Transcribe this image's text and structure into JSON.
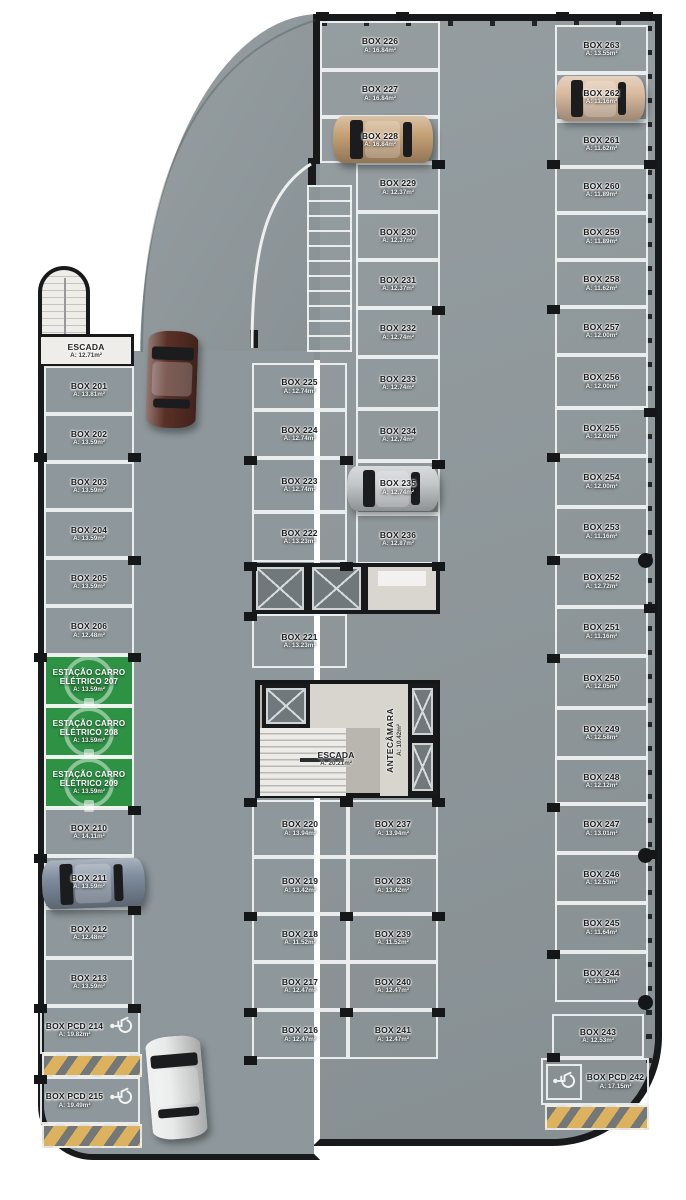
{
  "colors": {
    "floor": "#8e979b",
    "wall": "#17191b",
    "line": "#f4f6f6",
    "station_green": "#2e9245",
    "hatch_yellow": "#dcb25f"
  },
  "plan": {
    "rooms": {
      "stair_left": {
        "name": "ESCADA",
        "area": "A: 12.71m²"
      },
      "stair_core": {
        "name": "ESCADA",
        "area": "A: 20.21m²"
      },
      "antechamber": {
        "name": "ANTECÂMARA",
        "area": "A: 10.42m²"
      }
    },
    "boxes": [
      {
        "label": "BOX 201",
        "area": "A: 13.81m²",
        "x": 44,
        "y": 366,
        "w": 90,
        "h": 48
      },
      {
        "label": "BOX 202",
        "area": "A: 13.59m²",
        "x": 44,
        "y": 414,
        "w": 90,
        "h": 48
      },
      {
        "label": "BOX 203",
        "area": "A: 13.59m²",
        "x": 44,
        "y": 462,
        "w": 90,
        "h": 48
      },
      {
        "label": "BOX 204",
        "area": "A: 13.59m²",
        "x": 44,
        "y": 510,
        "w": 90,
        "h": 48
      },
      {
        "label": "BOX 205",
        "area": "A: 13.59m²",
        "x": 44,
        "y": 558,
        "w": 90,
        "h": 48
      },
      {
        "label": "BOX 206",
        "area": "A: 12.48m²",
        "x": 44,
        "y": 606,
        "w": 90,
        "h": 49
      },
      {
        "label": "BOX 210",
        "area": "A: 14.11m²",
        "x": 44,
        "y": 808,
        "w": 90,
        "h": 48
      },
      {
        "label": "BOX 211",
        "area": "A: 13.59m²",
        "x": 44,
        "y": 856,
        "w": 90,
        "h": 52
      },
      {
        "label": "BOX 212",
        "area": "A: 12.48m²",
        "x": 44,
        "y": 908,
        "w": 90,
        "h": 50
      },
      {
        "label": "BOX 213",
        "area": "A: 13.59m²",
        "x": 44,
        "y": 958,
        "w": 90,
        "h": 48
      },
      {
        "label": "BOX 216",
        "area": "A: 12.47m²",
        "x": 252,
        "y": 1010,
        "w": 96,
        "h": 49
      },
      {
        "label": "BOX 217",
        "area": "A: 12.47m²",
        "x": 252,
        "y": 962,
        "w": 96,
        "h": 48
      },
      {
        "label": "BOX 218",
        "area": "A: 11.52m²",
        "x": 252,
        "y": 914,
        "w": 96,
        "h": 48
      },
      {
        "label": "BOX 219",
        "area": "A: 13.42m²",
        "x": 252,
        "y": 857,
        "w": 96,
        "h": 57
      },
      {
        "label": "BOX 220",
        "area": "A: 13.94m²",
        "x": 252,
        "y": 800,
        "w": 96,
        "h": 57
      },
      {
        "label": "BOX 221",
        "area": "A: 13.23m²",
        "x": 252,
        "y": 614,
        "w": 95,
        "h": 54
      },
      {
        "label": "BOX 222",
        "area": "A: 13.23m²",
        "x": 252,
        "y": 512,
        "w": 95,
        "h": 50
      },
      {
        "label": "BOX 223",
        "area": "A: 12.74m²",
        "x": 252,
        "y": 458,
        "w": 95,
        "h": 54
      },
      {
        "label": "BOX 224",
        "area": "A: 12.74m²",
        "x": 252,
        "y": 410,
        "w": 95,
        "h": 48
      },
      {
        "label": "BOX 225",
        "area": "A: 12.74m²",
        "x": 252,
        "y": 363,
        "w": 95,
        "h": 47
      },
      {
        "label": "BOX 226",
        "area": "A: 16.84m²",
        "x": 320,
        "y": 21,
        "w": 120,
        "h": 49
      },
      {
        "label": "BOX 227",
        "area": "A: 16.84m²",
        "x": 320,
        "y": 70,
        "w": 120,
        "h": 47
      },
      {
        "label": "BOX 228",
        "area": "A: 16.84m²",
        "x": 320,
        "y": 117,
        "w": 120,
        "h": 46
      },
      {
        "label": "BOX 229",
        "area": "A: 12.37m²",
        "x": 356,
        "y": 163,
        "w": 84,
        "h": 49
      },
      {
        "label": "BOX 230",
        "area": "A: 12.37m²",
        "x": 356,
        "y": 212,
        "w": 84,
        "h": 48
      },
      {
        "label": "BOX 231",
        "area": "A: 12.37m²",
        "x": 356,
        "y": 260,
        "w": 84,
        "h": 48
      },
      {
        "label": "BOX 232",
        "area": "A: 12.74m²",
        "x": 356,
        "y": 308,
        "w": 84,
        "h": 49
      },
      {
        "label": "BOX 233",
        "area": "A: 12.74m²",
        "x": 356,
        "y": 357,
        "w": 84,
        "h": 52
      },
      {
        "label": "BOX 234",
        "area": "A: 12.74m²",
        "x": 356,
        "y": 409,
        "w": 84,
        "h": 52
      },
      {
        "label": "BOX 235",
        "area": "A: 12.74m²",
        "x": 356,
        "y": 461,
        "w": 84,
        "h": 53
      },
      {
        "label": "BOX 236",
        "area": "A: 12.87m²",
        "x": 356,
        "y": 514,
        "w": 84,
        "h": 50
      },
      {
        "label": "BOX 237",
        "area": "A: 13.94m²",
        "x": 348,
        "y": 800,
        "w": 90,
        "h": 57
      },
      {
        "label": "BOX 238",
        "area": "A: 13.42m²",
        "x": 348,
        "y": 857,
        "w": 90,
        "h": 57
      },
      {
        "label": "BOX 239",
        "area": "A: 11.52m²",
        "x": 348,
        "y": 914,
        "w": 90,
        "h": 48
      },
      {
        "label": "BOX 240",
        "area": "A: 12.47m²",
        "x": 348,
        "y": 962,
        "w": 90,
        "h": 48
      },
      {
        "label": "BOX 241",
        "area": "A: 12.47m²",
        "x": 348,
        "y": 1010,
        "w": 90,
        "h": 49
      },
      {
        "label": "BOX 243",
        "area": "A: 12.53m²",
        "x": 552,
        "y": 1014,
        "w": 92,
        "h": 44
      },
      {
        "label": "BOX 244",
        "area": "A: 12.53m²",
        "x": 555,
        "y": 952,
        "w": 93,
        "h": 50
      },
      {
        "label": "BOX 245",
        "area": "A: 11.64m²",
        "x": 555,
        "y": 903,
        "w": 93,
        "h": 49
      },
      {
        "label": "BOX 246",
        "area": "A: 12.53m²",
        "x": 555,
        "y": 853,
        "w": 93,
        "h": 50
      },
      {
        "label": "BOX 247",
        "area": "A: 13.01m²",
        "x": 555,
        "y": 804,
        "w": 93,
        "h": 49
      },
      {
        "label": "BOX 248",
        "area": "A: 12.12m²",
        "x": 555,
        "y": 758,
        "w": 93,
        "h": 46
      },
      {
        "label": "BOX 249",
        "area": "A: 12.58m²",
        "x": 555,
        "y": 708,
        "w": 93,
        "h": 50
      },
      {
        "label": "BOX 250",
        "area": "A: 12.05m²",
        "x": 555,
        "y": 656,
        "w": 93,
        "h": 52
      },
      {
        "label": "BOX 251",
        "area": "A: 11.16m²",
        "x": 555,
        "y": 607,
        "w": 93,
        "h": 49
      },
      {
        "label": "BOX 252",
        "area": "A: 12.72m²",
        "x": 555,
        "y": 556,
        "w": 93,
        "h": 51
      },
      {
        "label": "BOX 253",
        "area": "A: 11.16m²",
        "x": 555,
        "y": 507,
        "w": 93,
        "h": 49
      },
      {
        "label": "BOX 254",
        "area": "A: 12.00m²",
        "x": 555,
        "y": 456,
        "w": 93,
        "h": 51
      },
      {
        "label": "BOX 255",
        "area": "A: 12.00m²",
        "x": 555,
        "y": 408,
        "w": 93,
        "h": 48
      },
      {
        "label": "BOX 256",
        "area": "A: 12.00m²",
        "x": 555,
        "y": 355,
        "w": 93,
        "h": 53
      },
      {
        "label": "BOX 257",
        "area": "A: 12.00m²",
        "x": 555,
        "y": 307,
        "w": 93,
        "h": 48
      },
      {
        "label": "BOX 258",
        "area": "A: 11.62m²",
        "x": 555,
        "y": 260,
        "w": 93,
        "h": 47
      },
      {
        "label": "BOX 259",
        "area": "A: 11.89m²",
        "x": 555,
        "y": 213,
        "w": 93,
        "h": 47
      },
      {
        "label": "BOX 260",
        "area": "A: 11.89m²",
        "x": 555,
        "y": 167,
        "w": 93,
        "h": 46
      },
      {
        "label": "BOX 261",
        "area": "A: 11.62m²",
        "x": 555,
        "y": 121,
        "w": 93,
        "h": 46
      },
      {
        "label": "BOX 262",
        "area": "A: 11.16m²",
        "x": 555,
        "y": 73,
        "w": 93,
        "h": 48
      },
      {
        "label": "BOX 263",
        "area": "A: 13.55m²",
        "x": 555,
        "y": 25,
        "w": 93,
        "h": 48
      }
    ],
    "stations": [
      {
        "label": "ESTAÇÃO CARRO ELÉTRICO 207",
        "area": "A: 13.59m²",
        "x": 44,
        "y": 655,
        "w": 90,
        "h": 51
      },
      {
        "label": "ESTAÇÃO CARRO ELÉTRICO 208",
        "area": "A: 13.59m²",
        "x": 44,
        "y": 706,
        "w": 90,
        "h": 51
      },
      {
        "label": "ESTAÇÃO CARRO ELÉTRICO 209",
        "area": "A: 13.59m²",
        "x": 44,
        "y": 757,
        "w": 90,
        "h": 51
      }
    ],
    "pcd_boxes": [
      {
        "label": "BOX PCD 214",
        "area": "A: 19.82m²",
        "x": 40,
        "y": 1006,
        "w": 100,
        "h": 48,
        "icon": "right"
      },
      {
        "label": "BOX PCD 215",
        "area": "A: 19.49m²",
        "x": 40,
        "y": 1077,
        "w": 100,
        "h": 47,
        "icon": "right"
      },
      {
        "label": "BOX PCD 242",
        "area": "A: 17.15m²",
        "x": 541,
        "y": 1058,
        "w": 108,
        "h": 47,
        "icon": "left-boxed"
      }
    ],
    "hatches": [
      {
        "x": 42,
        "y": 1054,
        "w": 100,
        "h": 23
      },
      {
        "x": 42,
        "y": 1124,
        "w": 100,
        "h": 24
      },
      {
        "x": 545,
        "y": 1105,
        "w": 104,
        "h": 25
      }
    ],
    "elevators": [
      {
        "x": 252,
        "y": 563,
        "w": 56,
        "h": 51
      },
      {
        "x": 308,
        "y": 563,
        "w": 57,
        "h": 51
      },
      {
        "x": 262,
        "y": 684,
        "w": 48,
        "h": 44
      },
      {
        "x": 408,
        "y": 684,
        "w": 29,
        "h": 55
      },
      {
        "x": 408,
        "y": 739,
        "w": 29,
        "h": 56
      }
    ],
    "service_room": {
      "x": 364,
      "y": 563,
      "w": 76,
      "h": 51
    },
    "cars": [
      {
        "name": "car-tan-box228",
        "x": 333,
        "y": 116,
        "w": 100,
        "h": 47,
        "o": "h",
        "rot": 0,
        "color": "#c7a277"
      },
      {
        "name": "car-tan-box262",
        "x": 556,
        "y": 76,
        "w": 89,
        "h": 45,
        "o": "h",
        "rot": 0,
        "color": "#d9bb9f"
      },
      {
        "name": "car-brown-aisle-top",
        "x": 147,
        "y": 331,
        "w": 50,
        "h": 97,
        "o": "v",
        "rot": 2,
        "color": "#5a3026"
      },
      {
        "name": "car-silver-box235",
        "x": 347,
        "y": 466,
        "w": 92,
        "h": 45,
        "o": "h",
        "rot": 0,
        "color": "#c3c8cb"
      },
      {
        "name": "car-blue-box211",
        "x": 42,
        "y": 859,
        "w": 103,
        "h": 49,
        "o": "h",
        "rot": -2,
        "color": "#7e8c9d"
      },
      {
        "name": "car-white-aisle-bottom",
        "x": 149,
        "y": 1036,
        "w": 55,
        "h": 103,
        "o": "v",
        "rot": -5,
        "color": "#e8e9e9"
      }
    ],
    "pillars": [
      [
        316,
        12
      ],
      [
        396,
        12
      ],
      [
        556,
        12
      ],
      [
        640,
        12
      ],
      [
        644,
        160
      ],
      [
        644,
        408
      ],
      [
        644,
        604
      ],
      [
        644,
        850
      ],
      [
        547,
        160
      ],
      [
        547,
        305
      ],
      [
        547,
        453
      ],
      [
        547,
        556
      ],
      [
        547,
        654
      ],
      [
        547,
        803
      ],
      [
        547,
        950
      ],
      [
        547,
        1053
      ],
      [
        128,
        453
      ],
      [
        128,
        556
      ],
      [
        128,
        653
      ],
      [
        128,
        806
      ],
      [
        128,
        906
      ],
      [
        128,
        1004
      ],
      [
        34,
        453
      ],
      [
        34,
        653
      ],
      [
        34,
        854
      ],
      [
        34,
        1004
      ],
      [
        34,
        1075
      ],
      [
        244,
        456
      ],
      [
        244,
        562
      ],
      [
        244,
        612
      ],
      [
        244,
        798
      ],
      [
        244,
        912
      ],
      [
        244,
        1008
      ],
      [
        244,
        1056
      ],
      [
        340,
        456
      ],
      [
        340,
        562
      ],
      [
        340,
        798
      ],
      [
        340,
        912
      ],
      [
        340,
        1008
      ],
      [
        432,
        160
      ],
      [
        432,
        306
      ],
      [
        432,
        460
      ],
      [
        432,
        562
      ],
      [
        432,
        798
      ],
      [
        432,
        912
      ],
      [
        432,
        1008
      ]
    ],
    "round_pillars": [
      [
        638,
        553
      ],
      [
        638,
        848
      ],
      [
        638,
        995
      ]
    ]
  }
}
